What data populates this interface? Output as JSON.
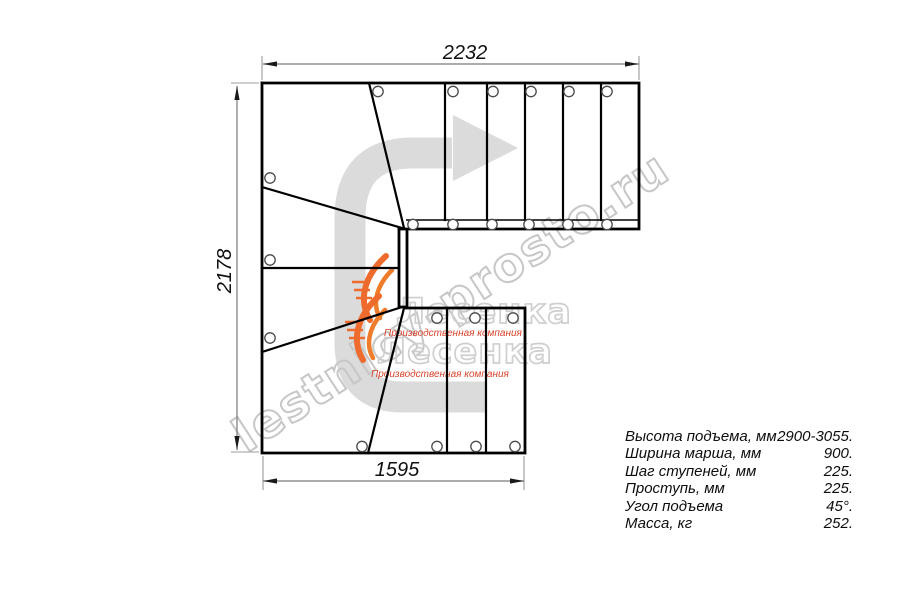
{
  "page": {
    "title": "Чертеж лестницы — план (вид сверху)"
  },
  "dimensions": {
    "top_mm": "2232",
    "left_mm": "2178",
    "bottom_mm": "1595"
  },
  "specs": {
    "rows": [
      {
        "label": "Высота подъема, мм",
        "value": "2900-3055."
      },
      {
        "label": "Ширина марша, мм",
        "value": "900."
      },
      {
        "label": "Шаг ступеней, мм",
        "value": "225."
      },
      {
        "label": "Проступь, мм",
        "value": "225."
      },
      {
        "label": "Угол подъема",
        "value": "45°."
      },
      {
        "label": "Масса, кг",
        "value": "252."
      }
    ]
  },
  "watermark": {
    "url_text": "lestnicy-prosto.ru",
    "logo_text": "Лесенка",
    "logo_tagline": "Производственная компания",
    "colors": {
      "arrow_gray": "#dbdbdb",
      "outline_gray": "#c7c7c7",
      "flame_orange": "#ee6b2d",
      "tagline_red": "#d9432c",
      "line_black": "#000000",
      "dim_gray": "#7a7a7a"
    }
  }
}
